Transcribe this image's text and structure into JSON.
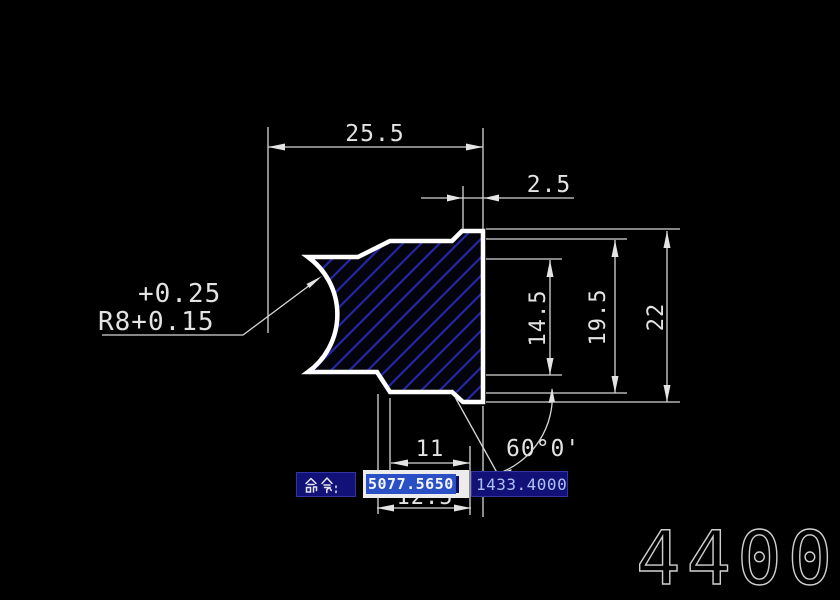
{
  "app": {
    "background_color": "#000000",
    "outline_color": "#ffffff",
    "hatch_color": "#2428aa",
    "dim_color": "#d6d6d6"
  },
  "drawing": {
    "dimensions": {
      "width_top": "25.5",
      "step_width": "2.5",
      "inner_height": "14.5",
      "mid_height": "19.5",
      "total_height": "22",
      "bottom_width": "11",
      "bottom_width_2": "12.5",
      "radius_note_line1": "+0.25",
      "radius_note_line2": "R8+0.15",
      "chamfer_angle": "60°0'"
    },
    "sheet_number": "4400"
  },
  "command_bar": {
    "prompt_label": "命令:",
    "x_value": "5077.5650",
    "y_value": "1433.4000"
  }
}
